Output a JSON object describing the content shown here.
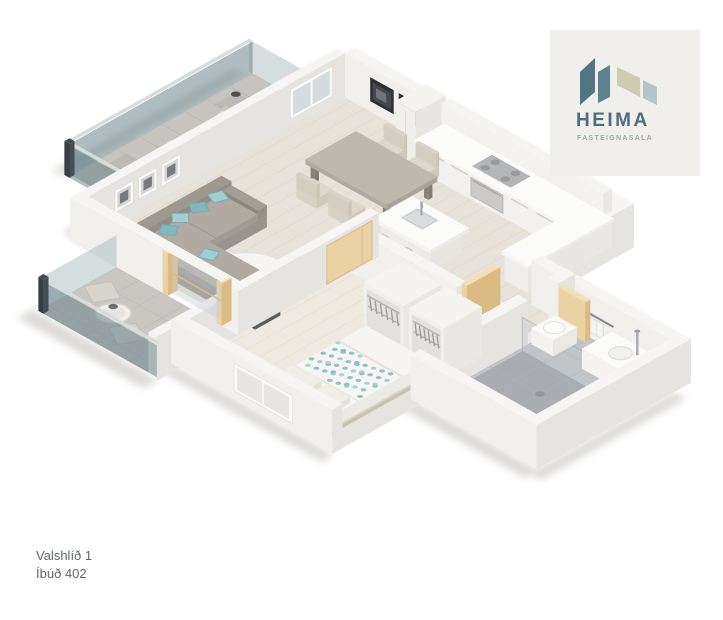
{
  "page": {
    "background": "#ffffff",
    "width": 723,
    "height": 620
  },
  "logo": {
    "brand": "HEIMA",
    "tagline": "FASTEIGNASALA",
    "panel_bg": "#f1efec",
    "brand_color": "#4d6f79",
    "tagline_color": "#9dac9f",
    "mark": {
      "shape1": "#517682",
      "shape2": "#5b828e",
      "shape3": "#cdccb2",
      "shape4": "#b4c5c9"
    }
  },
  "address": {
    "line1": "Valshlíð 1",
    "line2": "Íbúð 402",
    "color": "#616569"
  },
  "floorplan": {
    "type": "isometric-3d-apartment-floor-plan",
    "rooms": [
      "living-room",
      "dining-area",
      "kitchen",
      "hallway",
      "bedroom",
      "bathroom",
      "upper-balcony",
      "lower-balcony"
    ],
    "furniture": [
      "corner-sofa",
      "teal-accent-pillows",
      "armchairs",
      "round-rug",
      "dining-table",
      "dining-chairs",
      "kitchen-island",
      "bar-stools",
      "kitchen-cabinets",
      "cooktop",
      "oven",
      "double-bed",
      "open-wardrobes-with-hangers",
      "balcony-lounge-chairs",
      "balcony-bistro-table",
      "shower",
      "vanity-sink",
      "toilet",
      "towel-rail",
      "interior-wood-doors",
      "sliding-balcony-door",
      "wall-art-frames",
      "window"
    ],
    "colors": {
      "wallTop": "#f6f5f3",
      "wallLight": "#f2f0ed",
      "wallShade": "#e6e4e0",
      "woodFloor": "#e8e3da",
      "woodFloorLine": "#dcd6ca",
      "woodFloorBedroom": "#efeae1",
      "woodFloorBedroomLine": "#e3ddd2",
      "balconyTile": "#c7c4bf",
      "balconyTileLine": "#b3b0ab",
      "balconyTile2": "#cac7c2",
      "balconyTile2Line": "#b9b6b0",
      "bathTile": "#c3c5c7",
      "bathTileLine": "#b1b3b5",
      "showerTile": "#a9adb1",
      "glass": "rgba(96,124,129,0.50)",
      "glassLight": "rgba(150,172,176,0.40)",
      "glassRail": "#d8dcdc",
      "glassPost": "#434e52",
      "sofa": "#a5a099",
      "armchair": "#5f6266",
      "tealAccent": "#a2ced2",
      "tealAccentDark": "#7fb9bf",
      "doorWood": "#ead2a4",
      "doorWoodDark": "#dcba84",
      "metal": "#a2a7ab",
      "frameDark": "#2e3034",
      "shadow": "#b9b7b3"
    }
  }
}
